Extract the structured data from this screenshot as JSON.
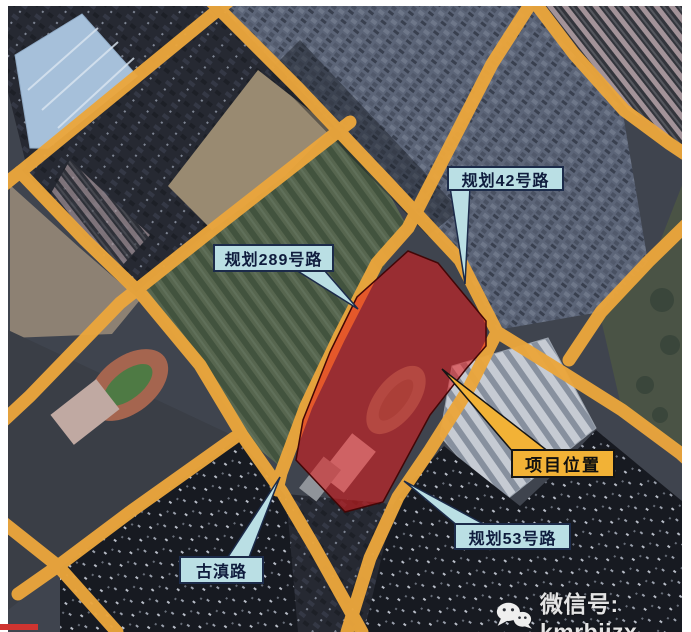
{
  "map": {
    "title_labels": {
      "road_42": "规划42号路",
      "road_289": "规划289号路",
      "road_53": "规划53号路",
      "gudian_road": "古滇路",
      "project_location": "项目位置"
    },
    "colors": {
      "road": "#EBA63C",
      "label_cyan_bg": "#BADFE4",
      "label_cyan_border": "#1C2B4A",
      "label_cyan_text": "#0F1C3D",
      "label_yellow_bg": "#F2B236",
      "label_yellow_border": "#151515",
      "label_yellow_text": "#101010",
      "project_area_fill": "#E41C1C",
      "frame_white": "#FFFFFF"
    }
  },
  "footer": {
    "wechat_label": "微信号: kmrbjjzx"
  }
}
